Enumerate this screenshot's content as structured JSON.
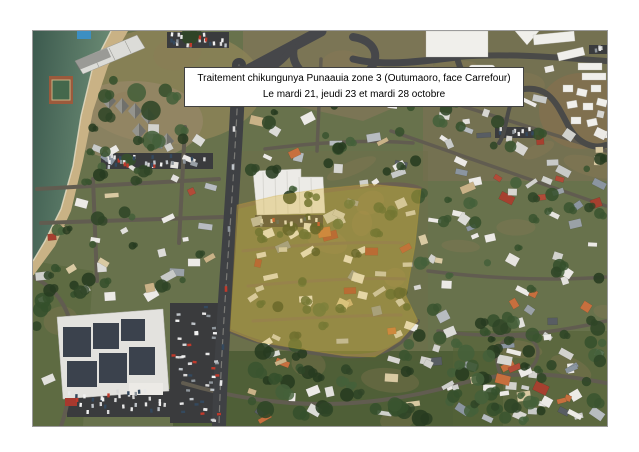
{
  "caption": {
    "line1": "Traitement chikungunya Punaauia zone 3 (Outumaoro, face Carrefour)",
    "line2": "Le mardi 21, jeudi 23 et mardi 28 octobre"
  },
  "map": {
    "kind": "satellite-aerial-photo",
    "highlight_color": "#d9b53c",
    "water_color": "#47665a",
    "beach_color": "#c9b285",
    "road_color": "#46474a",
    "vegetation_color": "#68724c"
  },
  "decoration": {
    "seed": 11,
    "house_colors": [
      "#eceae6",
      "#e2e1dc",
      "#d7d6d1",
      "#c8cac8",
      "#eceae6",
      "#dcdcd8",
      "#b7bcc0",
      "#b24b38",
      "#c76f3e",
      "#8b95a0",
      "#d9caa2",
      "#585d63",
      "#eceae6",
      "#cfd0cc",
      "#a6402f",
      "#e6e4df",
      "#9aa1a7",
      "#d2d2cd",
      "#c9b287",
      "#eceae6"
    ],
    "tree_colors": [
      "#2f4527",
      "#3a5430",
      "#273b20",
      "#44603a",
      "#35502c"
    ],
    "car_colors": [
      "#f2f2f2",
      "#d9d9d9",
      "#bfc4c9",
      "#8f969c",
      "#c0392b",
      "#34495e",
      "#e8e8e8"
    ],
    "house_regions": [
      {
        "x": 8,
        "y": 96,
        "w": 180,
        "h": 238,
        "n": 58
      },
      {
        "x": 196,
        "y": 150,
        "w": 195,
        "h": 168,
        "n": 64
      },
      {
        "x": 398,
        "y": 52,
        "w": 172,
        "h": 336,
        "n": 88
      },
      {
        "x": 214,
        "y": 50,
        "w": 172,
        "h": 98,
        "n": 26
      },
      {
        "x": 196,
        "y": 322,
        "w": 374,
        "h": 66,
        "n": 34
      },
      {
        "x": 2,
        "y": 240,
        "w": 56,
        "h": 150,
        "n": 9
      },
      {
        "x": 446,
        "y": 0,
        "w": 126,
        "h": 52,
        "n": 10
      }
    ],
    "tree_regions": [
      {
        "x": 16,
        "y": 4,
        "w": 190,
        "h": 112,
        "n": 30,
        "rmin": 4,
        "rmax": 10
      },
      {
        "x": 140,
        "y": 318,
        "w": 330,
        "h": 72,
        "n": 46,
        "rmin": 4,
        "rmax": 9
      },
      {
        "x": 0,
        "y": 175,
        "w": 75,
        "h": 218,
        "n": 26,
        "rmin": 3,
        "rmax": 8
      },
      {
        "x": 196,
        "y": 148,
        "w": 200,
        "h": 175,
        "n": 44,
        "rmin": 3,
        "rmax": 7
      },
      {
        "x": 396,
        "y": 40,
        "w": 176,
        "h": 350,
        "n": 52,
        "rmin": 3,
        "rmax": 7
      },
      {
        "x": 214,
        "y": 45,
        "w": 175,
        "h": 100,
        "n": 22,
        "rmin": 3,
        "rmax": 7
      },
      {
        "x": 8,
        "y": 96,
        "w": 185,
        "h": 235,
        "n": 34,
        "rmin": 3,
        "rmax": 7
      },
      {
        "x": 420,
        "y": 280,
        "w": 150,
        "h": 110,
        "n": 24,
        "rmin": 4,
        "rmax": 8
      }
    ],
    "parking_lots": [
      {
        "x": 137,
        "y": 272,
        "w": 52,
        "h": 120,
        "n": 46
      },
      {
        "x": 34,
        "y": 358,
        "w": 104,
        "h": 28,
        "n": 34
      },
      {
        "x": 68,
        "y": 122,
        "w": 112,
        "h": 16,
        "n": 30
      },
      {
        "x": 134,
        "y": 1,
        "w": 62,
        "h": 16,
        "n": 20
      },
      {
        "x": 222,
        "y": 184,
        "w": 68,
        "h": 12,
        "n": 14
      },
      {
        "x": 396,
        "y": 54,
        "w": 36,
        "h": 11,
        "n": 9
      },
      {
        "x": 462,
        "y": 96,
        "w": 40,
        "h": 11,
        "n": 9
      },
      {
        "x": 556,
        "y": 14,
        "w": 40,
        "h": 9,
        "n": 8
      }
    ],
    "fare_roofs": [
      [
        76,
        70
      ],
      [
        89,
        75
      ],
      [
        102,
        80
      ],
      [
        115,
        85
      ],
      [
        106,
        100
      ],
      [
        120,
        105
      ],
      [
        134,
        110
      ]
    ],
    "vehicles": [
      [
        203,
        62
      ],
      [
        201,
        98
      ],
      [
        200,
        136
      ],
      [
        196,
        198
      ],
      [
        193,
        258
      ],
      [
        190,
        316
      ],
      [
        188,
        352
      ]
    ],
    "dirt_patches": 24
  }
}
